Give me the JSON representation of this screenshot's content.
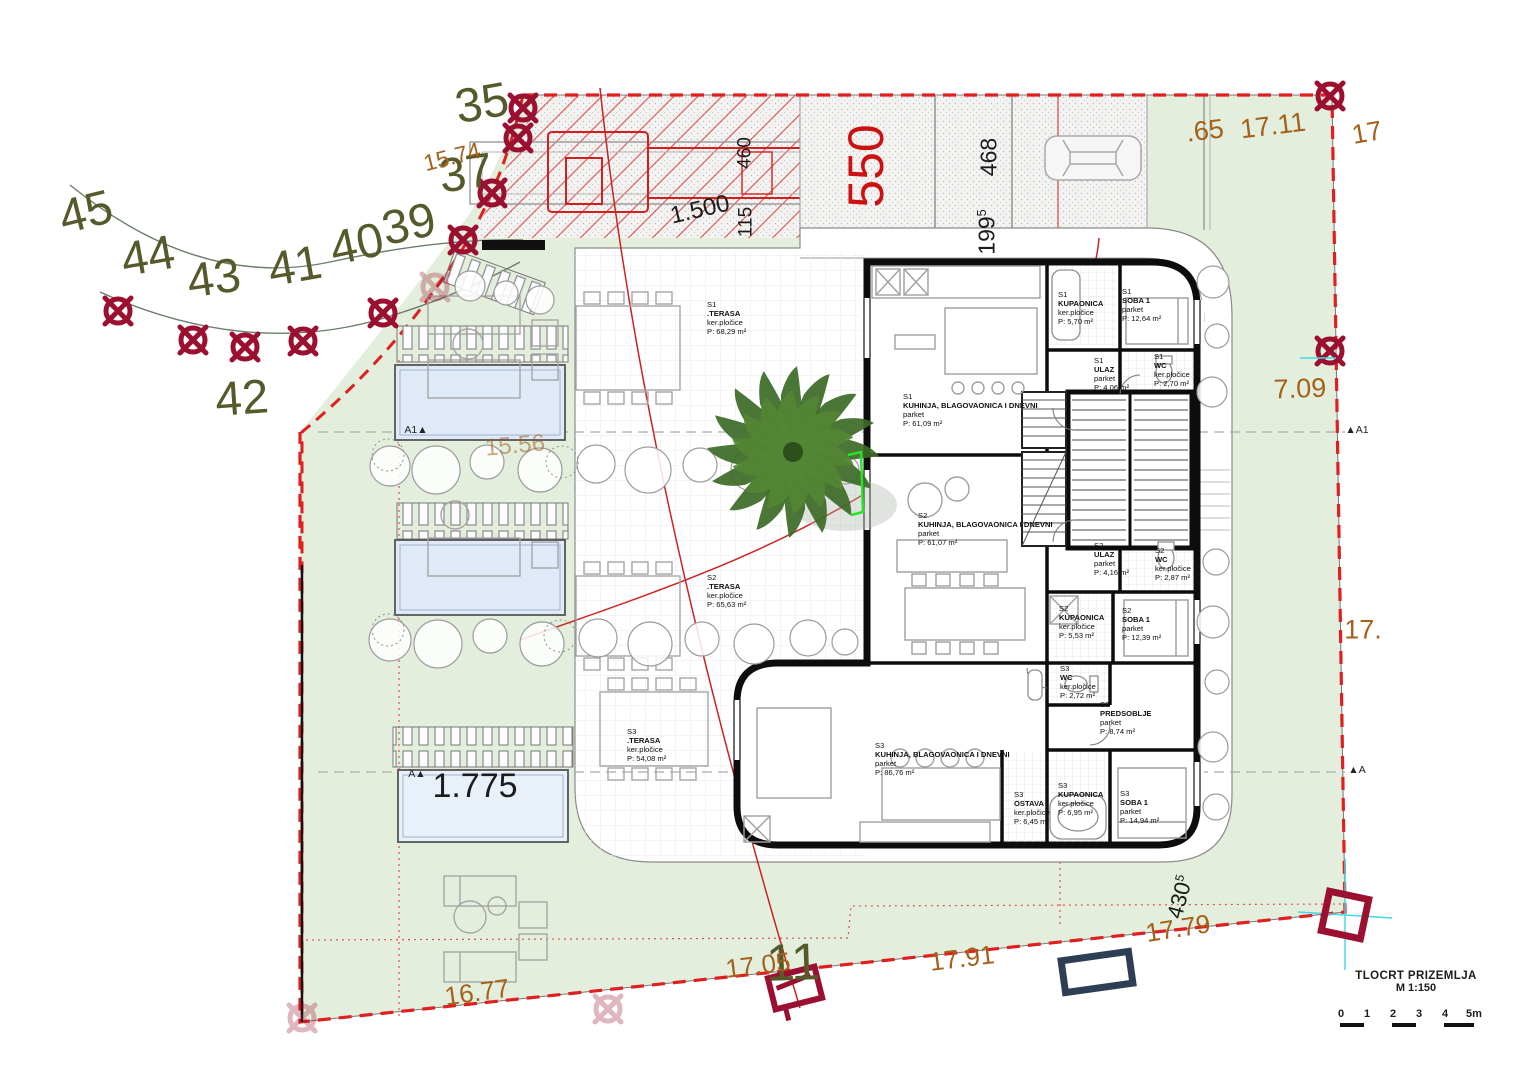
{
  "title_block": {
    "title": "TLOCRT PRIZEMLJA",
    "scale": "M 1:150",
    "scale_units": [
      "0",
      "1",
      "2",
      "3",
      "4",
      "5m"
    ]
  },
  "colors": {
    "survey_number": "#565a2b",
    "boundary_dim": "#a4611c",
    "plan_dim": "#1c1c1c",
    "red_dim": "#cc1111",
    "tree_marker": "#9b1030",
    "boundary_dash": "#e02020",
    "site_green": "#e3efdc",
    "pool_blue": "#dfe9f7",
    "survey_point_navy": "#2e3f55",
    "axis_cyan": "#3fd9e8"
  },
  "labels": [
    {
      "name": "survey-number-45",
      "text": "45",
      "x": 86,
      "y": 213,
      "size": 48,
      "rot": -14,
      "color": "#565a2b"
    },
    {
      "name": "survey-number-44",
      "text": "44",
      "x": 148,
      "y": 257,
      "size": 48,
      "rot": -10,
      "color": "#565a2b"
    },
    {
      "name": "survey-number-43",
      "text": "43",
      "x": 214,
      "y": 279,
      "size": 48,
      "rot": -8,
      "color": "#565a2b"
    },
    {
      "name": "survey-number-41",
      "text": "41",
      "x": 295,
      "y": 267,
      "size": 48,
      "rot": -10,
      "color": "#565a2b"
    },
    {
      "name": "survey-number-40",
      "text": "40",
      "x": 357,
      "y": 245,
      "size": 48,
      "rot": -12,
      "color": "#565a2b"
    },
    {
      "name": "survey-number-39",
      "text": "39",
      "x": 409,
      "y": 225,
      "size": 48,
      "rot": -12,
      "color": "#565a2b"
    },
    {
      "name": "survey-number-37",
      "text": "37",
      "x": 466,
      "y": 174,
      "size": 48,
      "rot": -8,
      "color": "#565a2b"
    },
    {
      "name": "survey-number-35",
      "text": "35",
      "x": 482,
      "y": 104,
      "size": 48,
      "rot": -10,
      "color": "#565a2b"
    },
    {
      "name": "survey-number-42",
      "text": "42",
      "x": 242,
      "y": 399,
      "size": 48,
      "rot": -4,
      "color": "#565a2b"
    },
    {
      "name": "survey-number-11",
      "text": "11",
      "x": 793,
      "y": 963,
      "size": 52,
      "rot": -2,
      "color": "#565a2b"
    },
    {
      "name": "boundary-dim-15-74",
      "text": "15.74",
      "x": 452,
      "y": 157,
      "size": 23,
      "rot": -14,
      "color": "#a4611c"
    },
    {
      "name": "boundary-dim-65",
      "text": ".65",
      "x": 1205,
      "y": 131,
      "size": 27,
      "rot": -7,
      "color": "#a4611c"
    },
    {
      "name": "boundary-dim-17-11",
      "text": "17.11",
      "x": 1273,
      "y": 126,
      "size": 27,
      "rot": -7,
      "color": "#a4611c"
    },
    {
      "name": "boundary-dim-17-topright",
      "text": "17",
      "x": 1367,
      "y": 133,
      "size": 27,
      "rot": -10,
      "color": "#a4611c"
    },
    {
      "name": "boundary-dim-7-09",
      "text": "7.09",
      "x": 1300,
      "y": 389,
      "size": 27,
      "rot": -2,
      "color": "#a4611c"
    },
    {
      "name": "boundary-dim-17-midright",
      "text": "17.",
      "x": 1363,
      "y": 630,
      "size": 27,
      "rot": 0,
      "color": "#a4611c"
    },
    {
      "name": "boundary-dim-15-56",
      "text": "15.56",
      "x": 515,
      "y": 446,
      "size": 24,
      "rot": -5,
      "color": "#a4611c",
      "opacity": 0.55
    },
    {
      "name": "boundary-dim-16-77",
      "text": "16.77",
      "x": 477,
      "y": 992,
      "size": 26,
      "rot": -8,
      "color": "#a4611c"
    },
    {
      "name": "boundary-dim-17-05",
      "text": "17.05",
      "x": 758,
      "y": 965,
      "size": 26,
      "rot": -7,
      "color": "#a4611c"
    },
    {
      "name": "boundary-dim-17-91",
      "text": "17.91",
      "x": 962,
      "y": 958,
      "size": 26,
      "rot": -7,
      "color": "#a4611c"
    },
    {
      "name": "boundary-dim-17-79",
      "text": "17.79",
      "x": 1178,
      "y": 928,
      "size": 26,
      "rot": -9,
      "color": "#a4611c"
    },
    {
      "name": "plan-dim-1-500",
      "text": "1.500",
      "x": 700,
      "y": 210,
      "size": 24,
      "rot": -13,
      "color": "#1c1c1c"
    },
    {
      "name": "plan-dim-460",
      "text": "460",
      "x": 745,
      "y": 153,
      "size": 19,
      "rot": -90,
      "color": "#1c1c1c"
    },
    {
      "name": "plan-dim-115",
      "text": "115",
      "x": 746,
      "y": 222,
      "size": 19,
      "rot": -90,
      "color": "#1c1c1c"
    },
    {
      "name": "plan-dim-468",
      "text": "468",
      "x": 989,
      "y": 157,
      "size": 23,
      "rot": -90,
      "color": "#1c1c1c"
    },
    {
      "name": "plan-dim-199-5",
      "text": "199",
      "sup": "5",
      "x": 987,
      "y": 232,
      "size": 23,
      "rot": -90,
      "color": "#1c1c1c"
    },
    {
      "name": "plan-dim-430-5",
      "text": "430",
      "sup": "5",
      "x": 1180,
      "y": 897,
      "size": 22,
      "rot": -75,
      "color": "#1c1c1c"
    },
    {
      "name": "plan-dim-550",
      "text": "550",
      "x": 866,
      "y": 166,
      "size": 50,
      "rot": -90,
      "color": "#cc1111"
    },
    {
      "name": "pool-dim-1-775",
      "text": "1.775",
      "x": 475,
      "y": 786,
      "size": 34,
      "rot": 0,
      "color": "#1c1c1c"
    },
    {
      "name": "section-marker-a1-left",
      "text": "A1▲",
      "x": 416,
      "y": 430,
      "size": 10.5,
      "rot": 0,
      "color": "#222"
    },
    {
      "name": "section-marker-a1-right",
      "text": "▲A1",
      "x": 1357,
      "y": 430,
      "size": 10.5,
      "rot": 0,
      "color": "#222"
    },
    {
      "name": "section-marker-a-left",
      "text": "A▲",
      "x": 417,
      "y": 774,
      "size": 10.5,
      "rot": 0,
      "color": "#222"
    },
    {
      "name": "section-marker-a-right",
      "text": "▲A",
      "x": 1357,
      "y": 770,
      "size": 10.5,
      "rot": 0,
      "color": "#222"
    }
  ],
  "rooms": [
    {
      "id": "s1-terasa",
      "unit": "S1",
      "name": ".TERASA",
      "floor": "ker.pločice",
      "area": "P: 68,29 m²",
      "x": 707,
      "y": 300
    },
    {
      "id": "s1-kuhinja",
      "unit": "S1",
      "name": "KUHINJA, BLAGOVAONICA I DNEVNI",
      "floor": "parket",
      "area": "P: 61,09 m²",
      "x": 903,
      "y": 392
    },
    {
      "id": "s1-kupaonica",
      "unit": "S1",
      "name": "KUPAONICA",
      "floor": "ker.pločice",
      "area": "P: 5,70 m²",
      "x": 1058,
      "y": 290
    },
    {
      "id": "s1-soba1",
      "unit": "S1",
      "name": "SOBA 1",
      "floor": "parket",
      "area": "P: 12,64 m²",
      "x": 1122,
      "y": 287
    },
    {
      "id": "s1-ulaz",
      "unit": "S1",
      "name": "ULAZ",
      "floor": "parket",
      "area": "P: 4,06 m²",
      "x": 1094,
      "y": 356
    },
    {
      "id": "s1-wc",
      "unit": "S1",
      "name": "WC",
      "floor": "ker.pločice",
      "area": "P: 2,70 m²",
      "x": 1154,
      "y": 352
    },
    {
      "id": "s2-kuhinja",
      "unit": "S2",
      "name": "KUHINJA, BLAGOVAONICA I DNEVNI",
      "floor": "parket",
      "area": "P: 61,07 m²",
      "x": 918,
      "y": 511
    },
    {
      "id": "s2-ulaz",
      "unit": "S2",
      "name": "ULAZ",
      "floor": "parket",
      "area": "P: 4,16 m²",
      "x": 1094,
      "y": 541
    },
    {
      "id": "s2-wc",
      "unit": "S2",
      "name": "WC",
      "floor": "ker.pločice",
      "area": "P: 2,87 m²",
      "x": 1155,
      "y": 546
    },
    {
      "id": "s2-kupaonica",
      "unit": "S2",
      "name": "KUPAONICA",
      "floor": "ker.pločice",
      "area": "P: 5,53 m²",
      "x": 1059,
      "y": 604
    },
    {
      "id": "s2-soba1",
      "unit": "S2",
      "name": "SOBA 1",
      "floor": "parket",
      "area": "P: 12,39 m²",
      "x": 1122,
      "y": 606
    },
    {
      "id": "s2-terasa",
      "unit": "S2",
      "name": ".TERASA",
      "floor": "ker.pločice",
      "area": "P: 65,63 m²",
      "x": 707,
      "y": 573
    },
    {
      "id": "s3-terasa",
      "unit": "S3",
      "name": ".TERASA",
      "floor": "ker.pločice",
      "area": "P: 54,08 m²",
      "x": 627,
      "y": 727
    },
    {
      "id": "s3-wc",
      "unit": "S3",
      "name": "WC",
      "floor": "ker.pločice",
      "area": "P: 2,72 m²",
      "x": 1060,
      "y": 664
    },
    {
      "id": "s3-predsoblje",
      "unit": "S3",
      "name": "PREDSOBLJE",
      "floor": "parket",
      "area": "P: 8,74 m²",
      "x": 1100,
      "y": 700
    },
    {
      "id": "s3-kuhinja",
      "unit": "S3",
      "name": "KUHINJA, BLAGOVAONICA I DNEVNI",
      "floor": "parket",
      "area": "P: 86,76 m²",
      "x": 875,
      "y": 741
    },
    {
      "id": "s3-ostava",
      "unit": "S3",
      "name": "OSTAVA",
      "floor": "ker.pločice",
      "area": "P: 6,45 m²",
      "x": 1014,
      "y": 790
    },
    {
      "id": "s3-kupaonica",
      "unit": "S3",
      "name": "KUPAONICA",
      "floor": "ker.pločice",
      "area": "P: 6,95 m²",
      "x": 1058,
      "y": 781
    },
    {
      "id": "s3-soba1",
      "unit": "S3",
      "name": "SOBA 1",
      "floor": "parket",
      "area": "P: 14,94 m²",
      "x": 1120,
      "y": 789
    }
  ],
  "tree_markers": {
    "color": "#9b1030",
    "positions": [
      [
        523,
        108
      ],
      [
        518,
        138
      ],
      [
        492,
        193
      ],
      [
        463,
        240
      ],
      [
        118,
        311
      ],
      [
        193,
        340
      ],
      [
        245,
        347
      ],
      [
        303,
        341
      ],
      [
        383,
        313
      ],
      [
        1330,
        96
      ],
      [
        1330,
        351
      ]
    ],
    "faded_positions": [
      [
        435,
        287
      ],
      [
        608,
        1009
      ],
      [
        302,
        1018
      ]
    ]
  }
}
